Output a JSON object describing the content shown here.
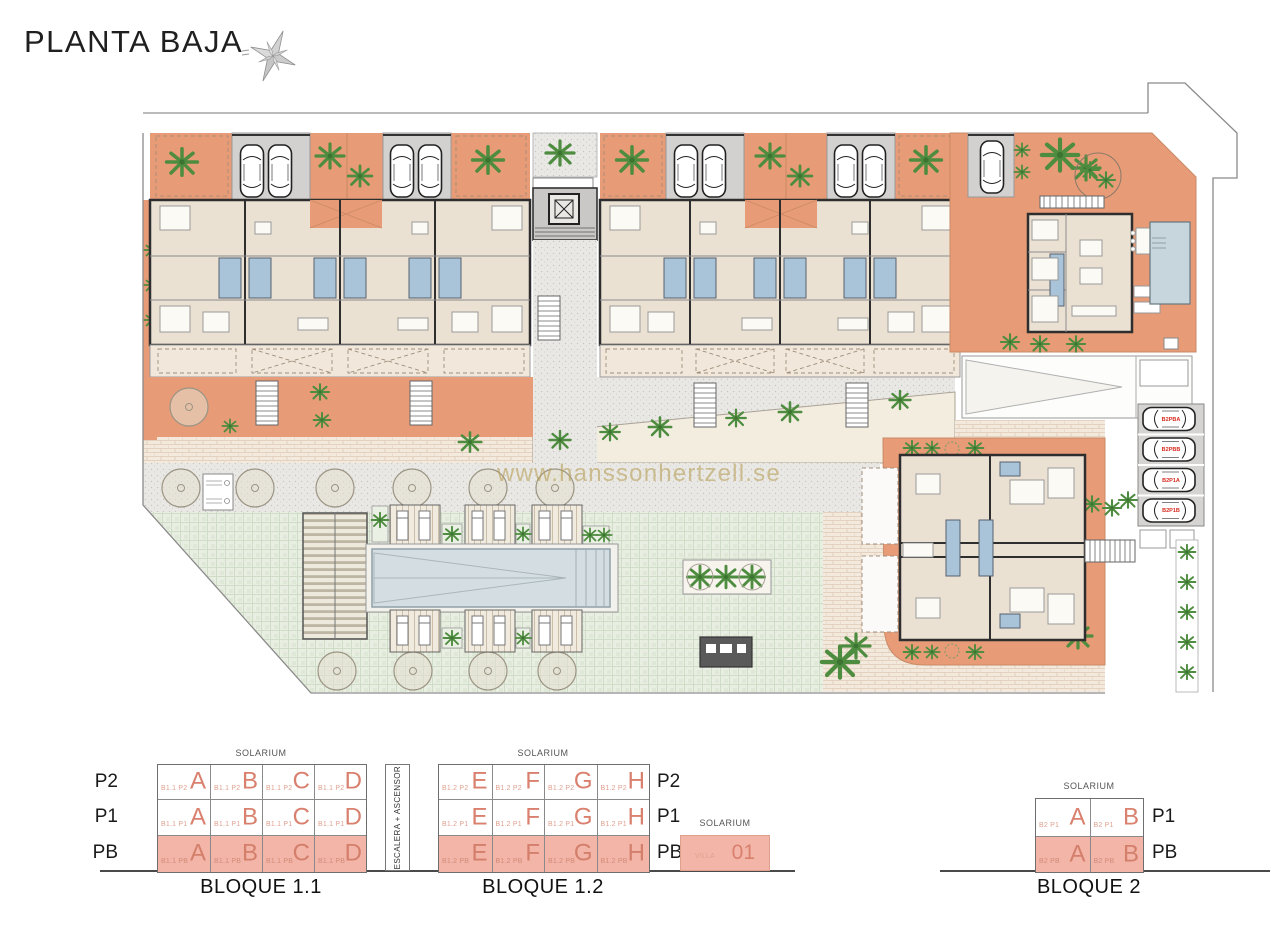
{
  "title": "PLANTA BAJA",
  "watermark": "www.hanssonhertzell.se",
  "icons": {
    "compass": "compass-rose"
  },
  "colors": {
    "terrace_salmon": "#E79B77",
    "floor_beige": "#EBE1D3",
    "diagram_pink": "#F3B5A7",
    "unit_letter_pink": "#D9806E",
    "lawn_green": "#E9EEE2",
    "pool_blue": "#D4DEE2",
    "plant_green": "#4E8C3F",
    "car_label_red": "#D62B1F",
    "watermark_gold": "#B79F55"
  },
  "site_plan": {
    "parking_labels": [
      "B2PBA",
      "B2PBB",
      "B2P1A",
      "B2P1B"
    ]
  },
  "diagrams": {
    "escalera_label": "ESCALERA + ASCENSOR",
    "bloque11": {
      "caption": "BLOQUE 1.1",
      "solarium": "SOLARIUM",
      "floors": [
        "P2",
        "P1",
        "PB"
      ],
      "rows": [
        [
          {
            "code": "B1.1 P2",
            "letter": "A"
          },
          {
            "code": "B1.1 P2",
            "letter": "B"
          },
          {
            "code": "B1.1 P2",
            "letter": "C"
          },
          {
            "code": "B1.1 P2",
            "letter": "D"
          }
        ],
        [
          {
            "code": "B1.1 P1",
            "letter": "A"
          },
          {
            "code": "B1.1 P1",
            "letter": "B"
          },
          {
            "code": "B1.1 P1",
            "letter": "C"
          },
          {
            "code": "B1.1 P1",
            "letter": "D"
          }
        ],
        [
          {
            "code": "B1.1 PB",
            "letter": "A"
          },
          {
            "code": "B1.1 PB",
            "letter": "B"
          },
          {
            "code": "B1.1 PB",
            "letter": "C"
          },
          {
            "code": "B1.1 PB",
            "letter": "D"
          }
        ]
      ]
    },
    "bloque12": {
      "caption": "BLOQUE 1.2",
      "solarium": "SOLARIUM",
      "floors": [
        "P2",
        "P1",
        "PB"
      ],
      "rows": [
        [
          {
            "code": "B1.2 P2",
            "letter": "E"
          },
          {
            "code": "B1.2 P2",
            "letter": "F"
          },
          {
            "code": "B1.2 P2",
            "letter": "G"
          },
          {
            "code": "B1.2 P2",
            "letter": "H"
          }
        ],
        [
          {
            "code": "B1.2 P1",
            "letter": "E"
          },
          {
            "code": "B1.2 P1",
            "letter": "F"
          },
          {
            "code": "B1.2 P1",
            "letter": "G"
          },
          {
            "code": "B1.2 P1",
            "letter": "H"
          }
        ],
        [
          {
            "code": "B1.2 PB",
            "letter": "E"
          },
          {
            "code": "B1.2 PB",
            "letter": "F"
          },
          {
            "code": "B1.2 PB",
            "letter": "G"
          },
          {
            "code": "B1.2 PB",
            "letter": "H"
          }
        ]
      ]
    },
    "villa": {
      "solarium": "SOLARIUM",
      "code": "VILLA",
      "number": "01"
    },
    "bloque2": {
      "caption": "BLOQUE 2",
      "solarium": "SOLARIUM",
      "floors": [
        "P1",
        "PB"
      ],
      "rows": [
        [
          {
            "code": "B2 P1",
            "letter": "A"
          },
          {
            "code": "B2 P1",
            "letter": "B"
          }
        ],
        [
          {
            "code": "B2 PB",
            "letter": "A"
          },
          {
            "code": "B2 PB",
            "letter": "B"
          }
        ]
      ]
    }
  }
}
